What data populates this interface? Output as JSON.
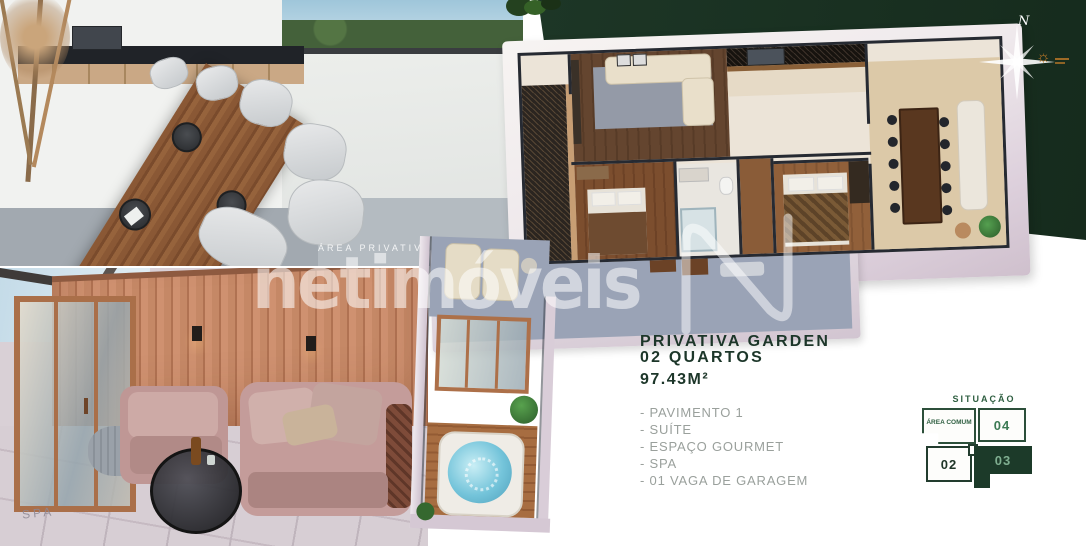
{
  "brand": {
    "watermark_text": "netimóveis"
  },
  "plan_labels": {
    "area_privativa": "ÁREA PRIVATIVA",
    "spa": "SPA"
  },
  "compass": {
    "north_label": "N",
    "sun_icon": "☼"
  },
  "listing": {
    "title_line1": "PRIVATIVA GARDEN",
    "title_line2": "02 QUARTOS",
    "area": "97.43M²",
    "features": [
      "- PAVIMENTO 1",
      "- SUÍTE",
      "- ESPAÇO GOURMET",
      "- SPA",
      "- 01 VAGA DE GARAGEM"
    ]
  },
  "situacao": {
    "title": "SITUAÇÃO",
    "common_area_label": "ÁREA COMUM",
    "units": {
      "u02": "02",
      "u03": "03",
      "u04": "04"
    },
    "highlighted": "03"
  },
  "colors": {
    "panel_green": "#1d3626",
    "heading_green": "#1c3629",
    "accent_green": "#3c7a54",
    "muted_gray": "#9aa09c",
    "sun_orange": "#c07a28",
    "watermark_white": "rgba(255,255,255,0.55)"
  }
}
